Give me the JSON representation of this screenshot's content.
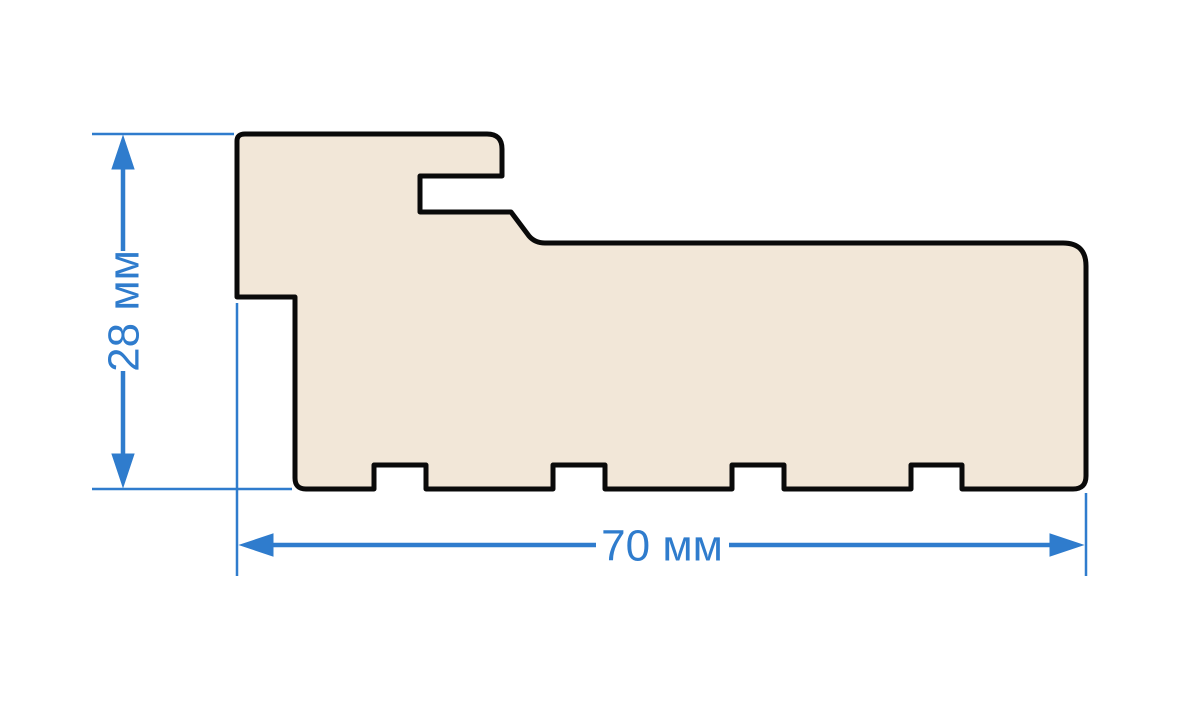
{
  "diagram": {
    "kind": "profile-cross-section",
    "dimensions": {
      "height": {
        "label": "28 мм",
        "value": 28,
        "unit": "мм"
      },
      "width": {
        "label": "70 мм",
        "value": 70,
        "unit": "мм"
      }
    }
  },
  "colors": {
    "dimension_blue": "#2f7ccd",
    "profile_fill": "#f2e7d8",
    "profile_outline": "#0a0a0a",
    "background": "#ffffff"
  }
}
